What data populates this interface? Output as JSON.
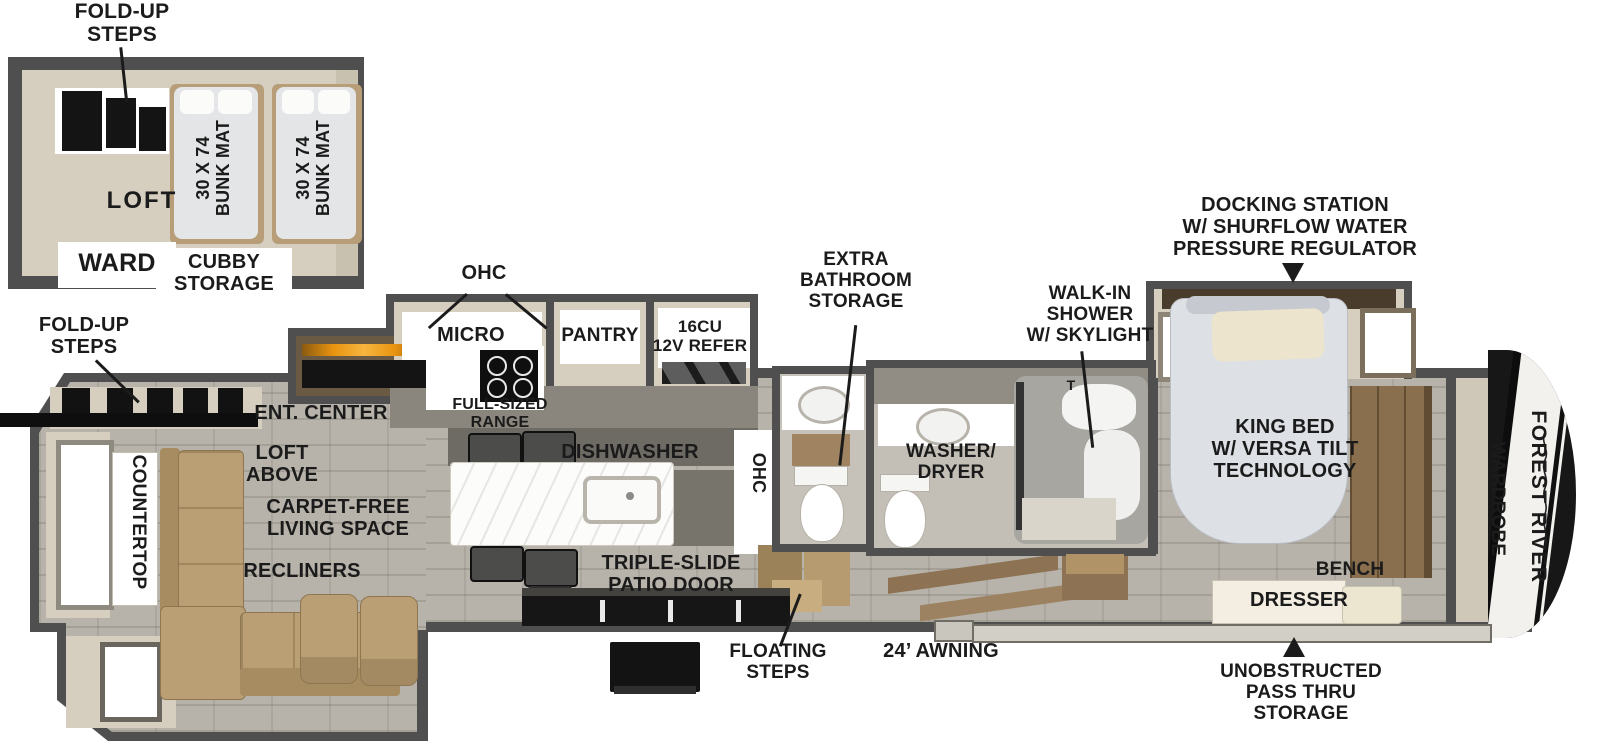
{
  "colors": {
    "wall": "#4f4f4f",
    "floor_beige": "#d6cfbf",
    "floor_tile": "#b7b3aa",
    "sofa_tan": "#bb9f74",
    "wood": "#8d7354",
    "label_ink": "#1b1b1b",
    "fireplace_orange": "#e8930f"
  },
  "loft_inset": {
    "fold_up_steps": "FOLD-UP\nSTEPS",
    "loft": "LOFT",
    "ward": "WARD",
    "cubby_storage": "CUBBY\nSTORAGE",
    "bunk_mat_left": "30 X 74\nBUNK MAT",
    "bunk_mat_right": "30 X 74\nBUNK MAT"
  },
  "living": {
    "fold_up_steps": "FOLD-UP\nSTEPS",
    "countertop": "COUNTERTOP",
    "ent_center": "ENT. CENTER",
    "loft_above": "LOFT\nABOVE",
    "carpet_free": "CARPET-FREE\nLIVING SPACE",
    "recliners": "RECLINERS"
  },
  "kitchen": {
    "ohc": "OHC",
    "micro": "MICRO",
    "pantry": "PANTRY",
    "refer": "16CU\n12V REFER",
    "range": "FULL-SIZED\nRANGE",
    "dishwasher": "DISHWASHER",
    "ohc_entry": "OHC",
    "patio_door": "TRIPLE-SLIDE\nPATIO DOOR"
  },
  "bath": {
    "extra_storage": "EXTRA\nBATHROOM\nSTORAGE",
    "washer_dryer": "WASHER/\nDRYER",
    "walk_in_shower": "WALK-IN\nSHOWER\nW/ SKYLIGHT",
    "shower_head": "T"
  },
  "bedroom": {
    "docking_station": "DOCKING STATION\nW/ SHURFLOW WATER\nPRESSURE REGULATOR",
    "king_bed": "KING BED\nW/ VERSA TILT\nTECHNOLOGY",
    "bench": "BENCH",
    "dresser": "DRESSER",
    "wardrobe": "WARDROBE"
  },
  "exterior": {
    "floating_steps": "FLOATING\nSTEPS",
    "awning": "24’ AWNING",
    "pass_thru": "UNOBSTRUCTED\nPASS THRU\nSTORAGE",
    "brand": "FOREST RIVER"
  }
}
